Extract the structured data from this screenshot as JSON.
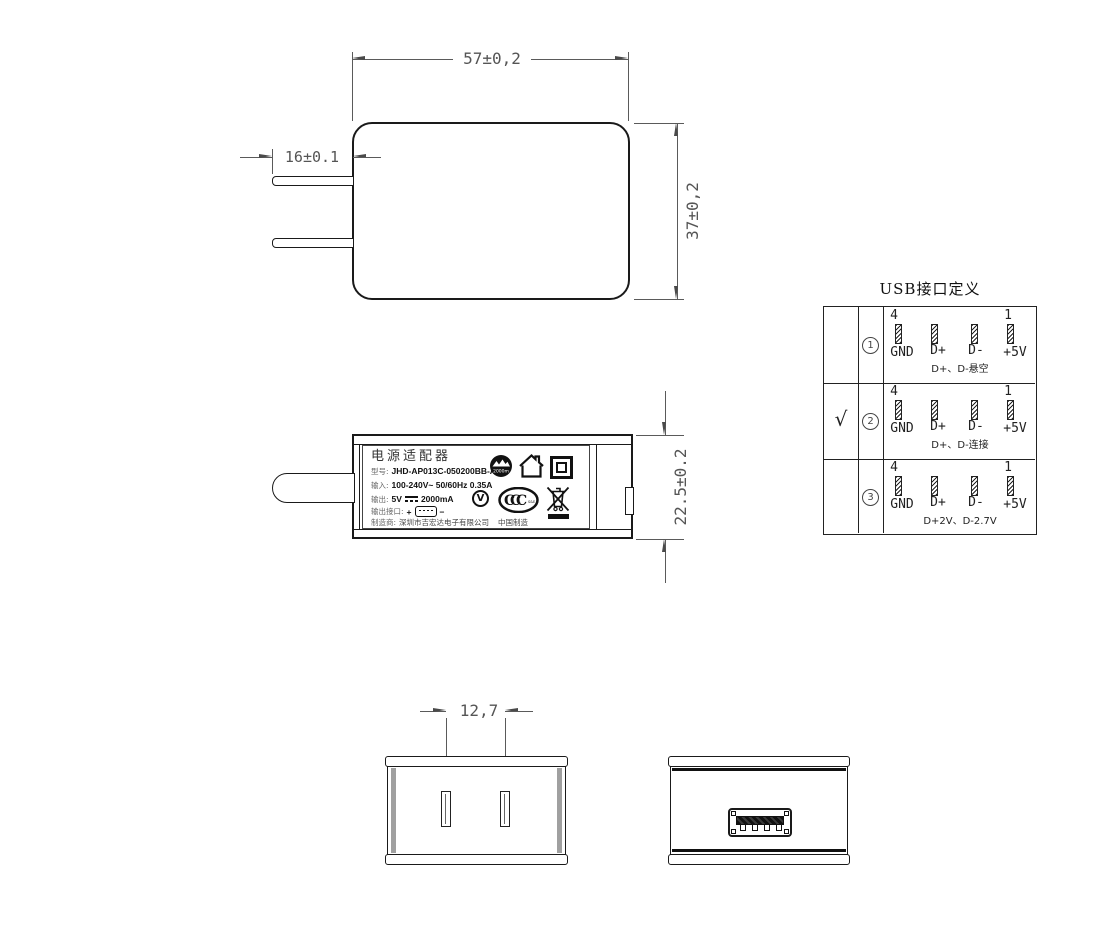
{
  "drawing": {
    "front_view": {
      "width_dim": "57±0,2",
      "height_dim": "37±0,2",
      "prong_dim": "16±0.1"
    },
    "side_view": {
      "height_dim": "22.5±0.2",
      "label": {
        "title": "电源适配器",
        "model_key": "型号:",
        "model_value": "JHD-AP013C-050200BB-A",
        "input_key": "输入:",
        "input_value": "100-240V~  50/60Hz  0.35A",
        "output_key": "输出:",
        "output_value_pre": "5V",
        "output_value_post": "2000mA",
        "port_key": "输出接口:",
        "port_plus": "+",
        "port_minus": "−",
        "maker_key": "制造商:",
        "maker_value": "深圳市吉宏达电子有限公司",
        "made_in": "中国制造",
        "altitude_text": "2000m",
        "ccc_c1": "C",
        "ccc_c2": "C",
        "ccc_c3": "C",
        "ccc_small": "S&E",
        "v_text": "V"
      }
    },
    "bottom_view": {
      "prong_spacing_dim": "12,7"
    },
    "usb_table": {
      "title": "USB接口定义",
      "pin_left_num": "4",
      "pin_right_num": "1",
      "pin_labels": [
        "GND",
        "D+",
        "D-",
        "+5V"
      ],
      "rows": [
        {
          "check": "",
          "num": "1",
          "note": "D+、D-悬空"
        },
        {
          "check": "√",
          "num": "2",
          "note": "D+、D-连接"
        },
        {
          "check": "",
          "num": "3",
          "note": "D+2V、D-2.7V"
        }
      ]
    }
  },
  "colors": {
    "object_line": "#1a1a1a",
    "dimension": "#555555",
    "gray_band": "#a0a0a0",
    "background": "#ffffff"
  }
}
